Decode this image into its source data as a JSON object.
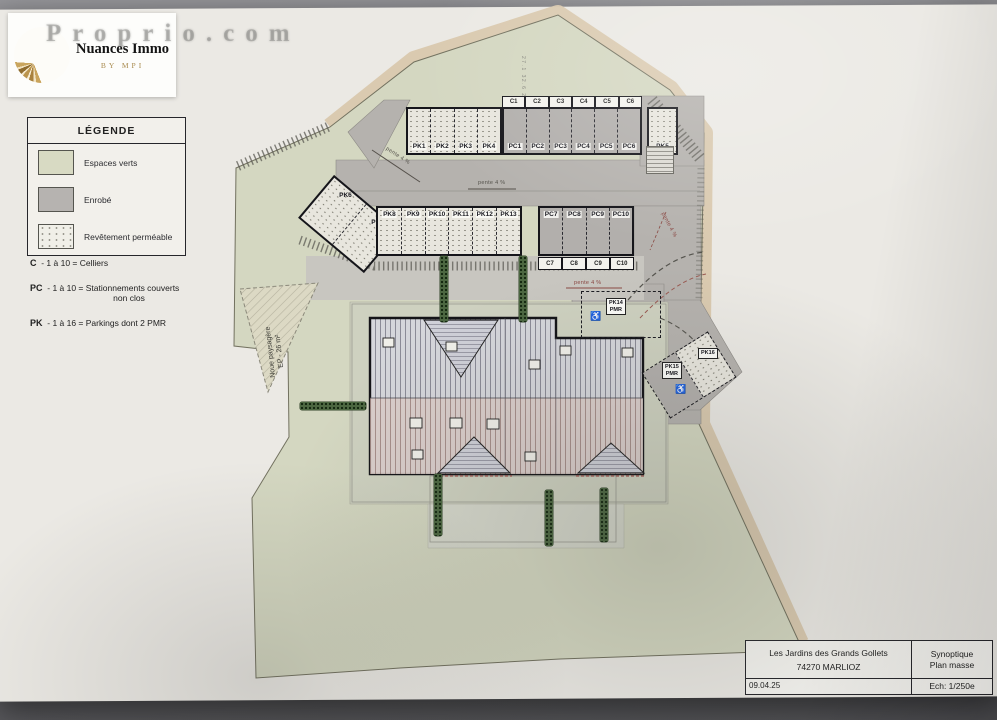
{
  "logo": {
    "brand": "Nuances Immo",
    "sub": "BY MPI"
  },
  "watermark": "Proprio.com",
  "legend": {
    "title": "LÉGENDE",
    "items": [
      {
        "label": "Espaces verts",
        "color": "#d8dac3"
      },
      {
        "label": "Enrobé",
        "color": "#b6b3b0"
      },
      {
        "label": "Revêtement perméable",
        "color": "stipple"
      }
    ],
    "codes": [
      {
        "code": "C",
        "desc": "- 1 à 10 = Celliers",
        "desc2": ""
      },
      {
        "code": "PC",
        "desc": "- 1 à 10 = Stationnements couverts",
        "desc2": "non clos"
      },
      {
        "code": "PK",
        "desc": "- 1 à 16 = Parkings dont 2 PMR",
        "desc2": ""
      }
    ]
  },
  "plan": {
    "celliers_row1": [
      "C1",
      "C2",
      "C3",
      "C4",
      "C5",
      "C6"
    ],
    "covered_row1": [
      "PC1",
      "PC2",
      "PC3",
      "PC4",
      "PC5",
      "PC6"
    ],
    "parkings_row1": [
      "PK1",
      "PK2",
      "PK3",
      "PK4"
    ],
    "parking_pk5": "PK5",
    "parkings_angled": [
      "PK6",
      "PK7"
    ],
    "parkings_row2": [
      "PK8",
      "PK9",
      "PK10",
      "PK11",
      "PK12",
      "PK13"
    ],
    "covered_row2": [
      "PC7",
      "PC8",
      "PC9",
      "PC10"
    ],
    "celliers_row2": [
      "C7",
      "C8",
      "C9",
      "C10"
    ],
    "pmr14_line1": "PK14",
    "pmr14_line2": "PMR",
    "pmr15_line1": "PK15",
    "pmr15_line2": "PMR",
    "pk16": "PK16",
    "noue_line1": "Noue paysagère",
    "noue_line2": "EP - 26 m²",
    "slope": "pente 4 %",
    "dim_note": "27.1 32.6 26"
  },
  "icons": {
    "pmr": "♿"
  },
  "titleblock": {
    "project": "Les Jardins des Grands Gollets",
    "city": "74270 MARLIOZ",
    "date": "09.04.25",
    "doc1": "Synoptique",
    "doc2": "Plan masse",
    "scale": "Ech: 1/250e"
  }
}
